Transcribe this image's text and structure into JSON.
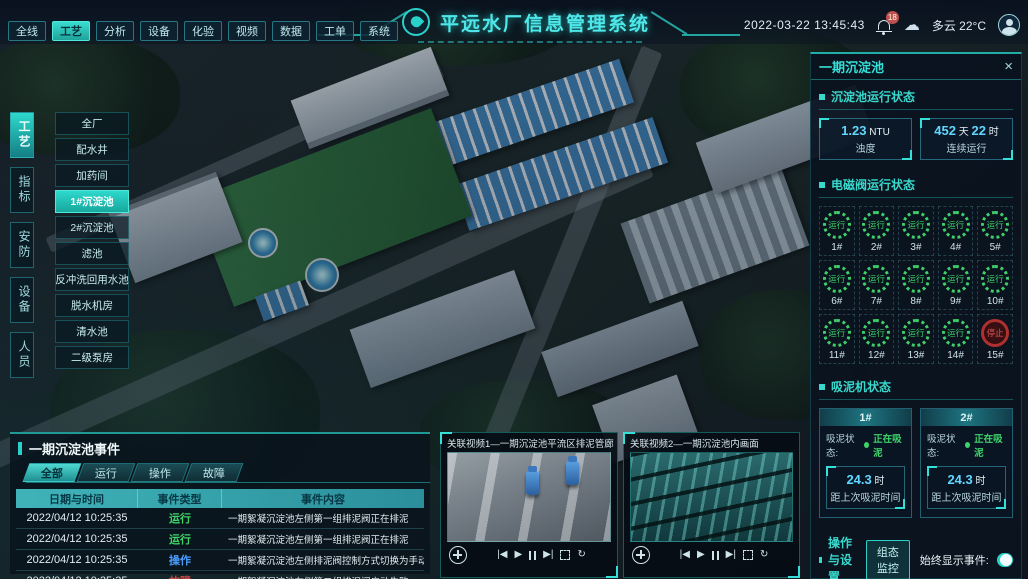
{
  "header": {
    "title": "平远水厂信息管理系统",
    "datetime": "2022-03-22 13:45:43",
    "badge": "18",
    "weather": "多云 22°C",
    "nav_tabs": [
      {
        "label": "全线",
        "active": false
      },
      {
        "label": "工艺",
        "active": true
      },
      {
        "label": "分析",
        "active": false
      },
      {
        "label": "设备",
        "active": false
      },
      {
        "label": "化验",
        "active": false
      },
      {
        "label": "视频",
        "active": false
      },
      {
        "label": "数据",
        "active": false
      },
      {
        "label": "工单",
        "active": false
      },
      {
        "label": "系统",
        "active": false
      }
    ]
  },
  "left_nav": {
    "category_tabs": [
      {
        "label": "工艺",
        "active": true
      },
      {
        "label": "指标",
        "active": false
      },
      {
        "label": "安防",
        "active": false
      },
      {
        "label": "设备",
        "active": false
      },
      {
        "label": "人员",
        "active": false
      }
    ],
    "menu_items": [
      {
        "label": "全厂",
        "active": false
      },
      {
        "label": "配水井",
        "active": false
      },
      {
        "label": "加药间",
        "active": false
      },
      {
        "label": "1#沉淀池",
        "active": true
      },
      {
        "label": "2#沉淀池",
        "active": false
      },
      {
        "label": "滤池",
        "active": false
      },
      {
        "label": "反冲洗回用水池",
        "active": false
      },
      {
        "label": "脱水机房",
        "active": false
      },
      {
        "label": "清水池",
        "active": false
      },
      {
        "label": "二级泵房",
        "active": false
      }
    ]
  },
  "right_panel": {
    "title": "一期沉淀池",
    "close_icon": "×",
    "tank": {
      "title": "沉淀池运行状态",
      "stats": [
        {
          "parts": [
            {
              "t": "1.23",
              "num": true
            },
            {
              "t": " NTU",
              "num": false
            }
          ],
          "label": "浊度"
        },
        {
          "parts": [
            {
              "t": "452",
              "num": true
            },
            {
              "t": " 天 ",
              "num": false
            },
            {
              "t": "22",
              "num": true
            },
            {
              "t": " 时",
              "num": false
            }
          ],
          "label": "连续运行"
        }
      ]
    },
    "valves": {
      "title": "电磁阀运行状态",
      "items": [
        {
          "id": "1#",
          "status": "运行",
          "state": "running"
        },
        {
          "id": "2#",
          "status": "运行",
          "state": "running"
        },
        {
          "id": "3#",
          "status": "运行",
          "state": "running"
        },
        {
          "id": "4#",
          "status": "运行",
          "state": "running"
        },
        {
          "id": "5#",
          "status": "运行",
          "state": "running"
        },
        {
          "id": "6#",
          "status": "运行",
          "state": "running"
        },
        {
          "id": "7#",
          "status": "运行",
          "state": "running"
        },
        {
          "id": "8#",
          "status": "运行",
          "state": "running"
        },
        {
          "id": "9#",
          "status": "运行",
          "state": "running"
        },
        {
          "id": "10#",
          "status": "运行",
          "state": "running"
        },
        {
          "id": "11#",
          "status": "运行",
          "state": "running"
        },
        {
          "id": "12#",
          "status": "运行",
          "state": "running"
        },
        {
          "id": "13#",
          "status": "运行",
          "state": "running"
        },
        {
          "id": "14#",
          "status": "运行",
          "state": "running"
        },
        {
          "id": "15#",
          "status": "停止",
          "state": "stopped"
        }
      ]
    },
    "pumps": {
      "title": "吸泥机状态",
      "cards": [
        {
          "id": "1#",
          "status_label": "吸泥状态:",
          "status": "正在吸泥",
          "parts": [
            {
              "t": "24.3",
              "num": true
            },
            {
              "t": " 时",
              "num": false
            }
          ],
          "value_label": "距上次吸泥时间"
        },
        {
          "id": "2#",
          "status_label": "吸泥状态:",
          "status": "正在吸泥",
          "parts": [
            {
              "t": "24.3",
              "num": true
            },
            {
              "t": " 时",
              "num": false
            }
          ],
          "value_label": "距上次吸泥时间"
        }
      ]
    },
    "ops": {
      "title": "操作与设置",
      "button": "组态监控",
      "toggle_label": "始终显示事件:",
      "toggle_on": true
    }
  },
  "events": {
    "title": "一期沉淀池事件",
    "tabs": [
      {
        "label": "全部",
        "active": true
      },
      {
        "label": "运行",
        "active": false
      },
      {
        "label": "操作",
        "active": false
      },
      {
        "label": "故障",
        "active": false
      }
    ],
    "columns": [
      "日期与时间",
      "事件类型",
      "事件内容"
    ],
    "type_colors": {
      "运行": "#3ed46a",
      "操作": "#4a9eff",
      "故障": "#c84545"
    },
    "rows": [
      {
        "datetime": "2022/04/12 10:25:35",
        "type": "运行",
        "content": "一期絮凝沉淀池左侧第一组排泥阀正在排泥"
      },
      {
        "datetime": "2022/04/12 10:25:35",
        "type": "运行",
        "content": "一期絮凝沉淀池左侧第一组排泥阀正在排泥"
      },
      {
        "datetime": "2022/04/12 10:25:35",
        "type": "操作",
        "content": "一期絮凝沉淀池左侧排泥阀控制方式切换为手动"
      },
      {
        "datetime": "2022/04/12 10:25:35",
        "type": "故障",
        "content": "一期絮凝沉淀池左侧第二组排泥阀启动失败"
      }
    ]
  },
  "videos": [
    {
      "title": "关联视频1—一期沉淀池平流区排泥管廊",
      "scene": "pumps"
    },
    {
      "title": "关联视频2—一期沉淀池内画面",
      "scene": "tank"
    }
  ],
  "colors": {
    "accent": "#2ad1c9",
    "value_blue": "#61d6ff",
    "running_green": "#3fd06b",
    "stopped_red": "#b03030"
  }
}
